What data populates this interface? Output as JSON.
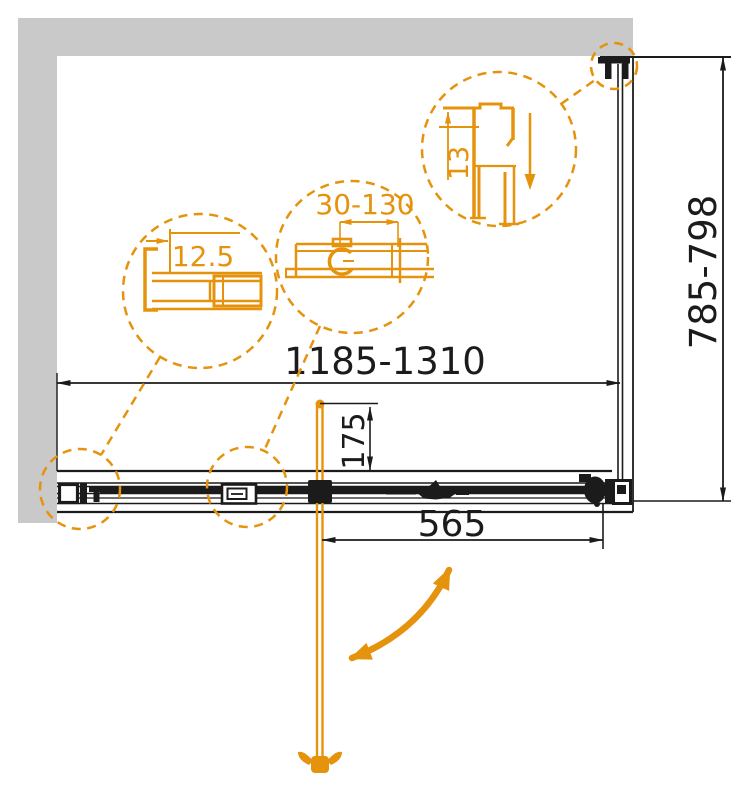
{
  "drawing": {
    "overall_width_label": "1185-1310",
    "overall_height_label": "785-798",
    "bar_offset_label": "175",
    "door_width_label": "565",
    "detail_wall_profile_label": "12.5",
    "detail_adjustment_range_label": "30-130",
    "detail_top_profile_label": "13"
  },
  "colors": {
    "accent_orange": "#E5930D",
    "wall_gray": "#C9C9C9",
    "line_black": "#1B1B1B",
    "background": "#FFFFFF"
  }
}
